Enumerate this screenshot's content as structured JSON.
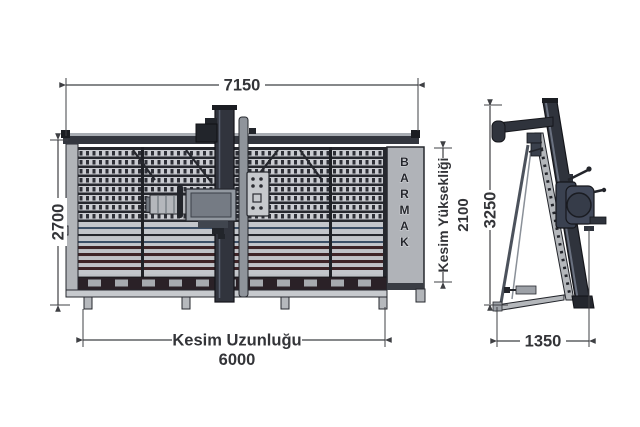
{
  "drawing": {
    "title": "panel-saw-technical-drawing",
    "views": [
      "front",
      "side"
    ]
  },
  "brand": {
    "name": "BARMAK",
    "letters": [
      "B",
      "A",
      "R",
      "M",
      "A",
      "K"
    ]
  },
  "dims": {
    "overall_width": "7150",
    "overall_height": "2700",
    "cut_height_label": "Kesim Yüksekliği",
    "cut_height_value": "2100",
    "cut_length_label": "Kesim Uzunluğu",
    "cut_length_value": "6000",
    "side_height": "3250",
    "side_depth": "1350"
  },
  "colors": {
    "machine_dark": "#31343d",
    "panel_gray": "#b0b3b8",
    "rail_light": "#caccd1",
    "rail_maroon": "#3e2427",
    "rail_steel_blue": "#3c4f66",
    "dimension": "#3f4044",
    "background": "#ffffff"
  }
}
